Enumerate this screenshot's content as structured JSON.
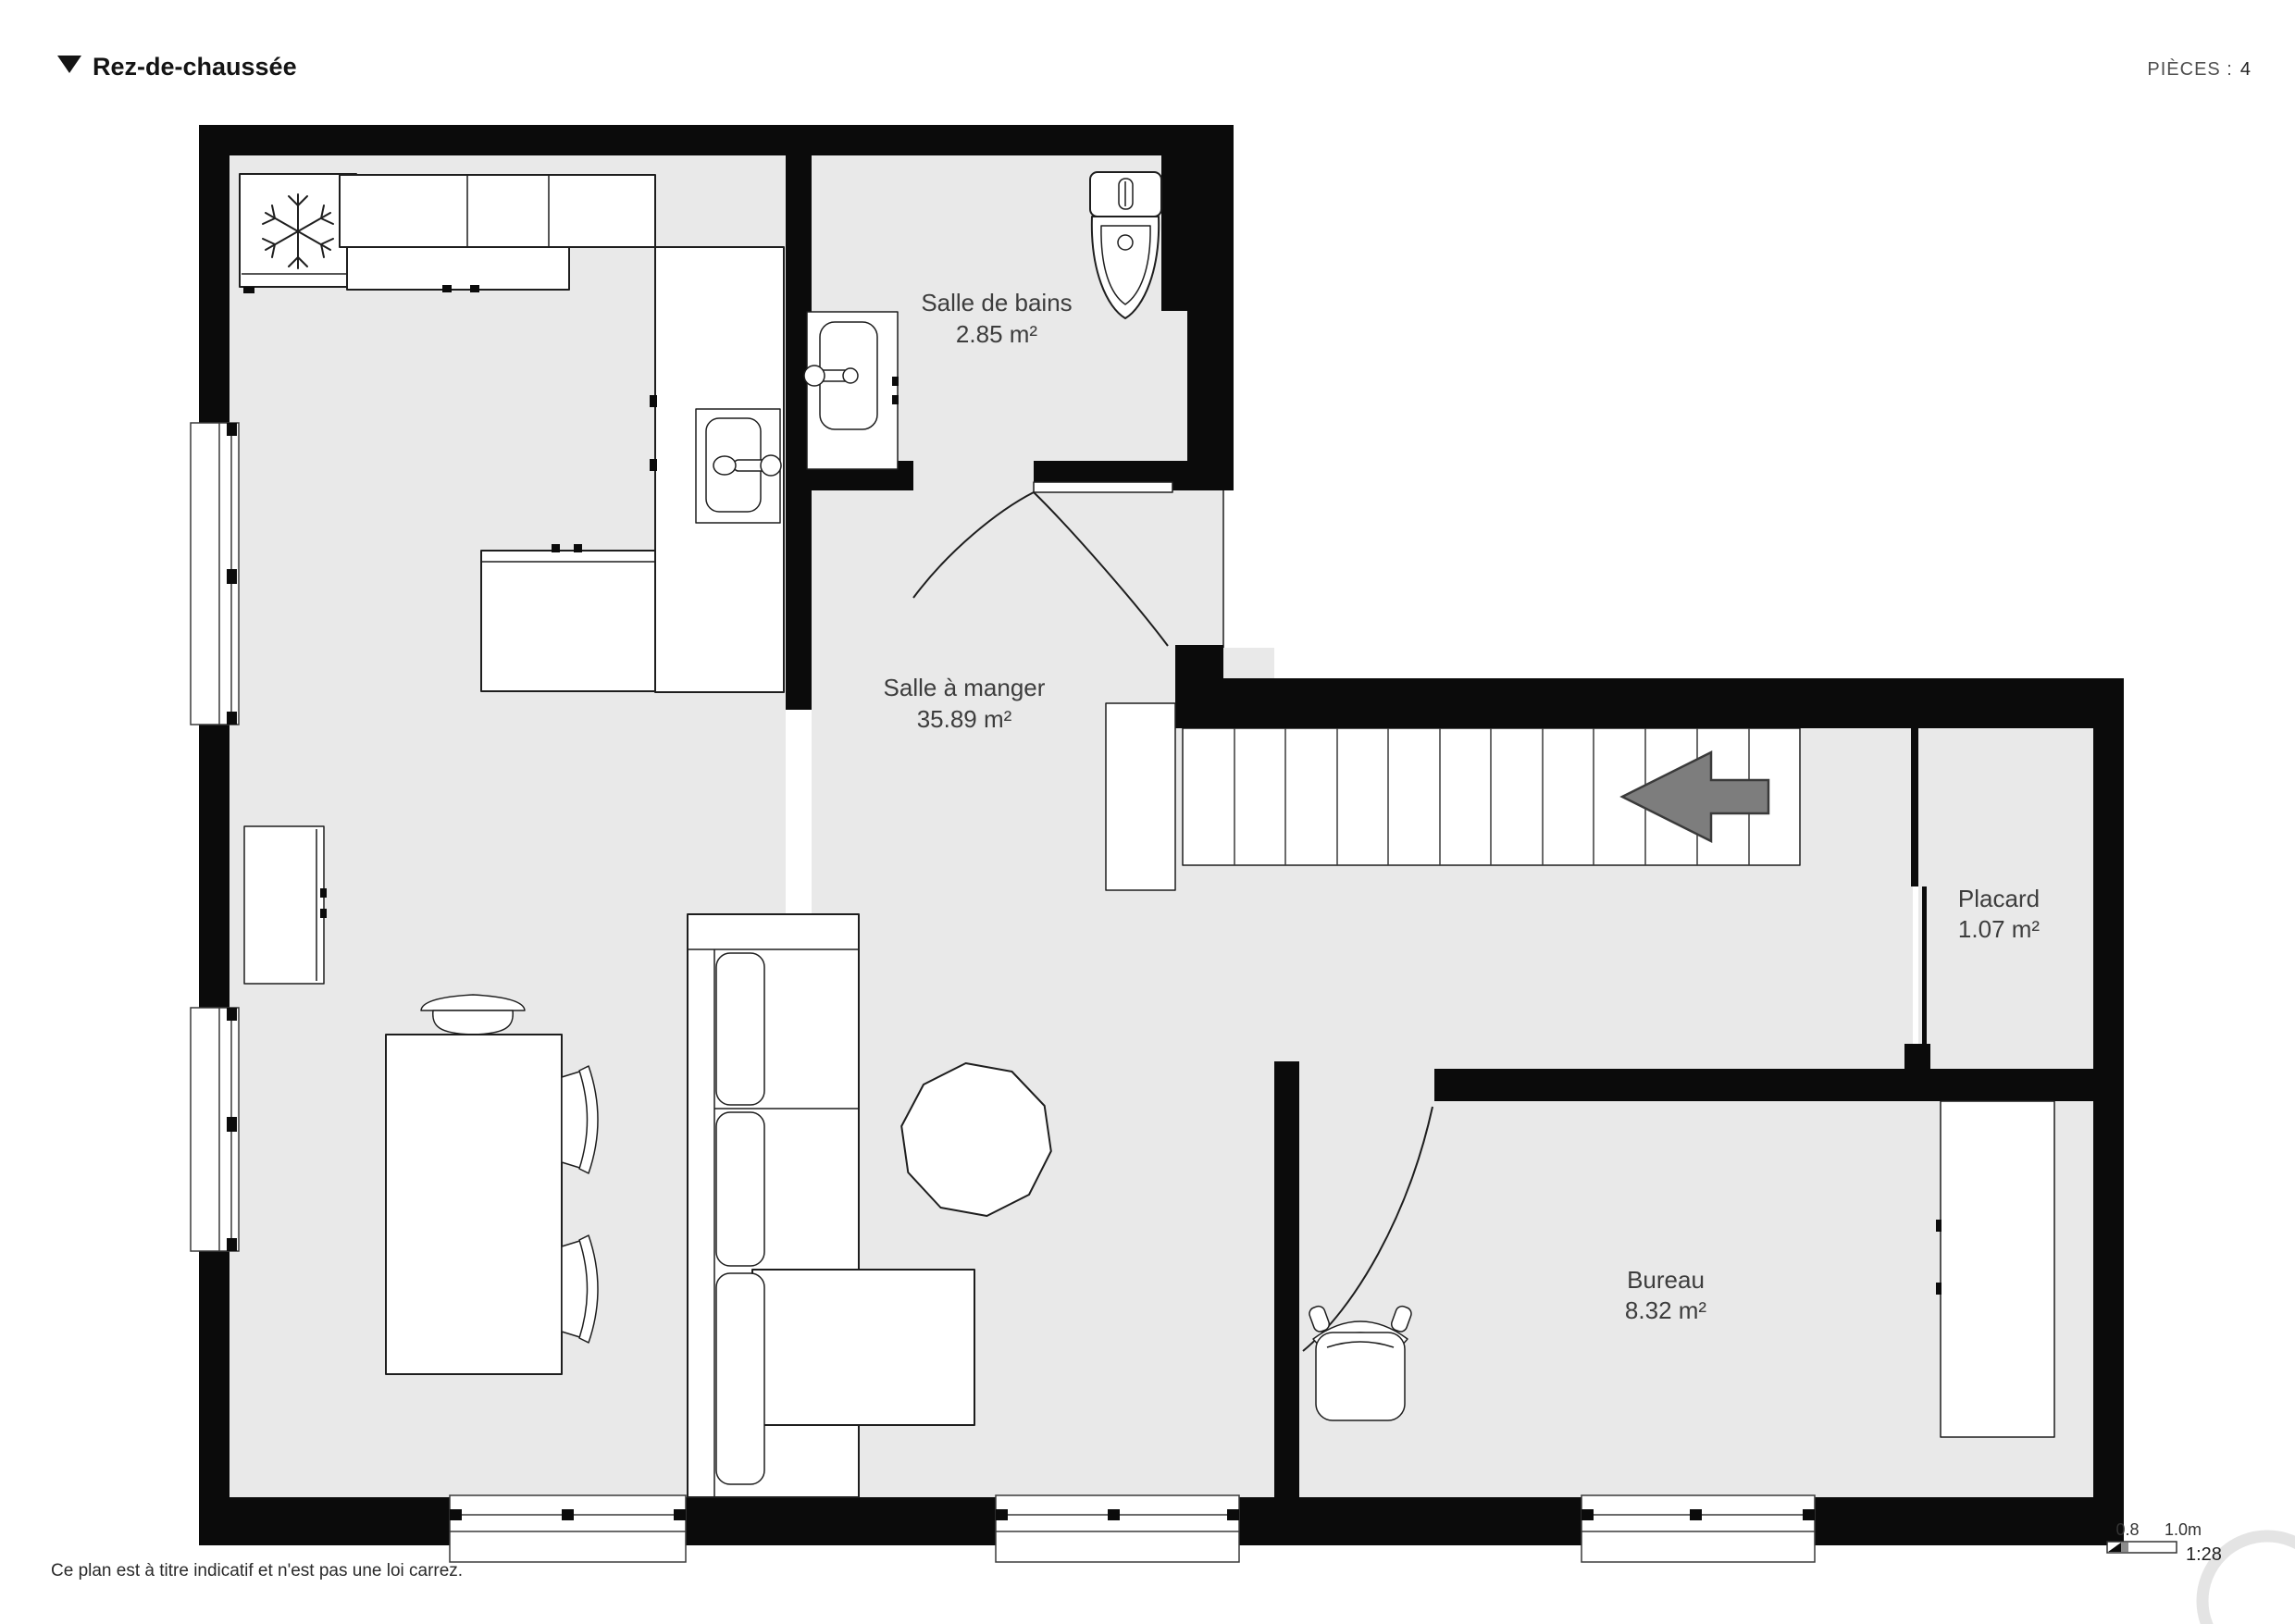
{
  "header": {
    "toggle_icon": "triangle-down",
    "title": "Rez-de-chaussée",
    "rooms_count_label": "PIÈCES :",
    "rooms_count_value": "4"
  },
  "rooms": {
    "bathroom": {
      "name": "Salle de bains",
      "area": "2.85 m²"
    },
    "dining": {
      "name": "Salle à manger",
      "area": "35.89 m²"
    },
    "closet": {
      "name": "Placard",
      "area": "1.07 m²"
    },
    "office": {
      "name": "Bureau",
      "area": "8.32 m²"
    }
  },
  "footer": {
    "disclaimer": "Ce plan est à titre indicatif et n'est pas une loi carrez."
  },
  "scale_bar": {
    "tick_start": "0.8",
    "tick_end": "1.0m",
    "ratio": "1:28"
  },
  "icons": {
    "fridge": "snowflake-icon",
    "stairs_direction": "arrow-left-icon",
    "header_toggle": "triangle-down-icon"
  },
  "colors": {
    "wall": "#0b0b0b",
    "floor": "#e9e9e9",
    "stairs_arrow": "#7d7d7d",
    "label_text": "#3d3d3d"
  }
}
